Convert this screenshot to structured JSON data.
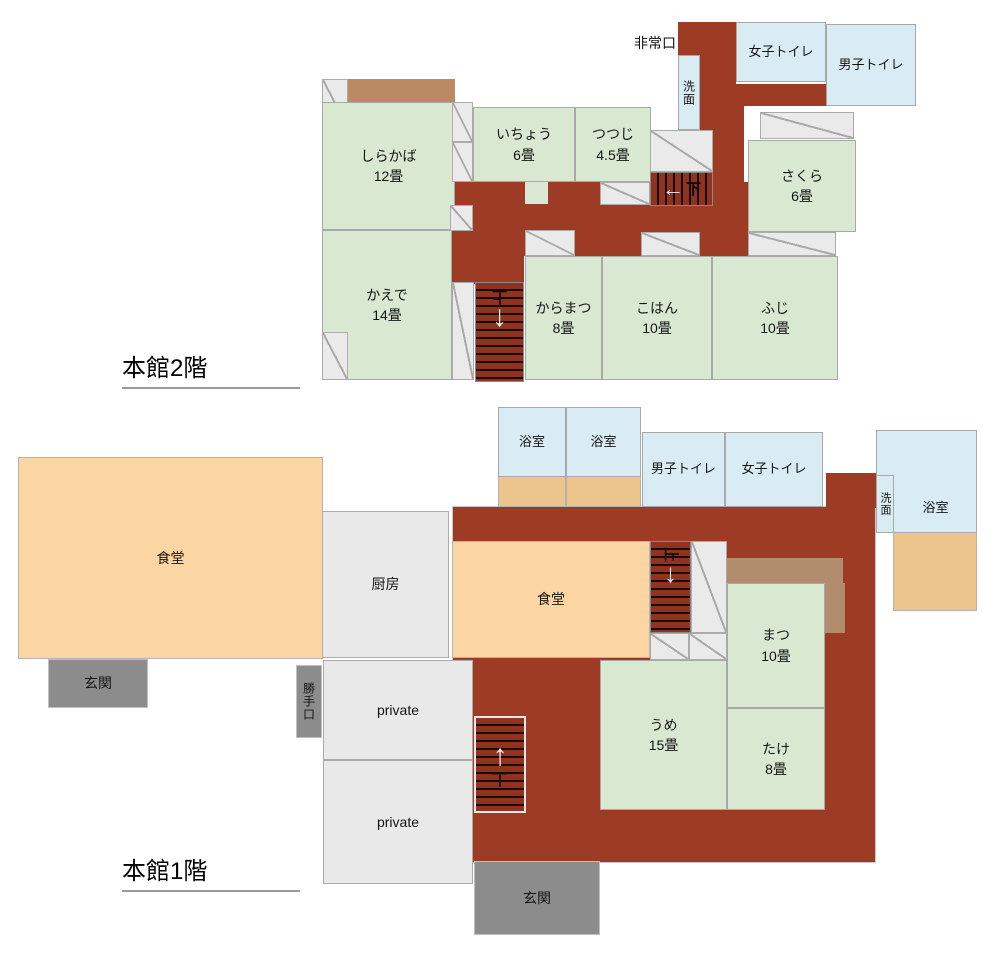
{
  "colors": {
    "corridor_red": "#9e3b25",
    "room_green": "#d9e8d1",
    "room_blue": "#d9ecf4",
    "dining_peach": "#fbd6a2",
    "bath_floor_tan": "#ecc58d",
    "veranda_brown": "#bc8a62",
    "service_gray": "#e9e9e9",
    "entrance_gray": "#8c8c8c"
  },
  "floor2": {
    "title": "本館2階",
    "emergency_exit": "非常口",
    "women_toilet": "女子トイレ",
    "men_toilet": "男子トイレ",
    "washroom": "洗面",
    "rooms": {
      "shirakaba": {
        "name": "しらかば",
        "size": "12畳"
      },
      "icho": {
        "name": "いちょう",
        "size": "6畳"
      },
      "tsutsuji": {
        "name": "つつじ",
        "size": "4.5畳"
      },
      "sakura": {
        "name": "さくら",
        "size": "6畳"
      },
      "kaede": {
        "name": "かえで",
        "size": "14畳"
      },
      "karamatsu": {
        "name": "からまつ",
        "size": "8畳"
      },
      "kohan": {
        "name": "こはん",
        "size": "10畳"
      },
      "fuji": {
        "name": "ふじ",
        "size": "10畳"
      }
    },
    "stairs": {
      "down": {
        "arrow": "←",
        "label": "下"
      },
      "up": {
        "arrow": "↓",
        "label": "上"
      }
    }
  },
  "floor1": {
    "title": "本館1階",
    "dining_hall": "食堂",
    "dining_annex": "食堂",
    "kitchen": "厨房",
    "entrance_front": "玄関",
    "entrance_side": "玄関",
    "back_door": "勝手口",
    "private_room": "private",
    "bath": "浴室",
    "men_toilet": "男子トイレ",
    "women_toilet": "女子トイレ",
    "washroom": "洗面",
    "rooms": {
      "matsu": {
        "name": "まつ",
        "size": "10畳"
      },
      "ume": {
        "name": "うめ",
        "size": "15畳"
      },
      "take": {
        "name": "たけ",
        "size": "8畳"
      }
    },
    "stairs": {
      "down": {
        "arrow": "↓",
        "label": "上"
      },
      "up": {
        "arrow": "↑",
        "label": "上"
      }
    }
  }
}
